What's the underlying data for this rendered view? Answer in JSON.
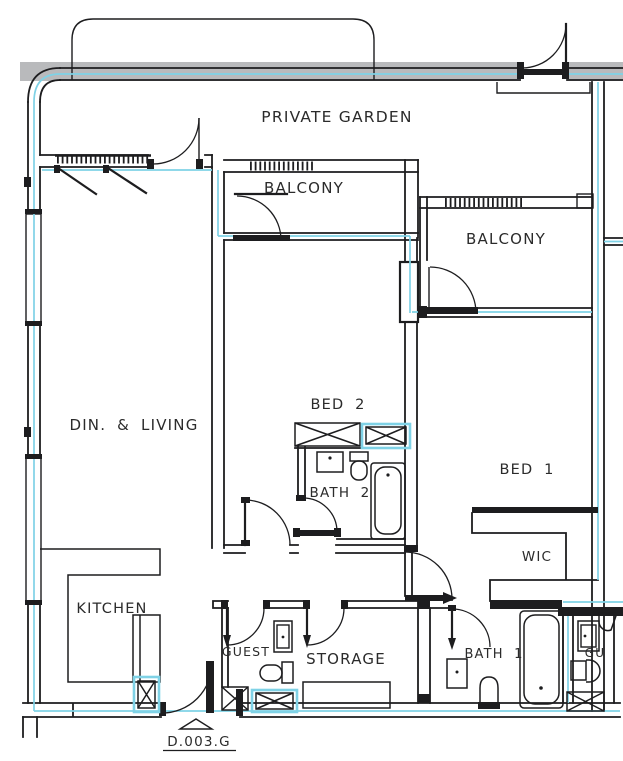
{
  "plan": {
    "labels": {
      "private_garden": "PRIVATE GARDEN",
      "balcony_left": "BALCONY",
      "balcony_right": "BALCONY",
      "din_living": "DIN. & LIVING",
      "bed2": "BED 2",
      "bath2": "BATH 2",
      "bed1": "BED 1",
      "wic": "WIC",
      "kitchen": "KITCHEN",
      "guest": "GUEST",
      "storage": "STORAGE",
      "bath1": "BATH 1",
      "neighbor_guest_partial": "GU",
      "door_tag": "D.003.G"
    },
    "colors": {
      "wall": "#1d1d1f",
      "accent_cyan": "#7fd2e6",
      "boundary_band_gray": "#b9babc",
      "paper": "#ffffff"
    }
  }
}
